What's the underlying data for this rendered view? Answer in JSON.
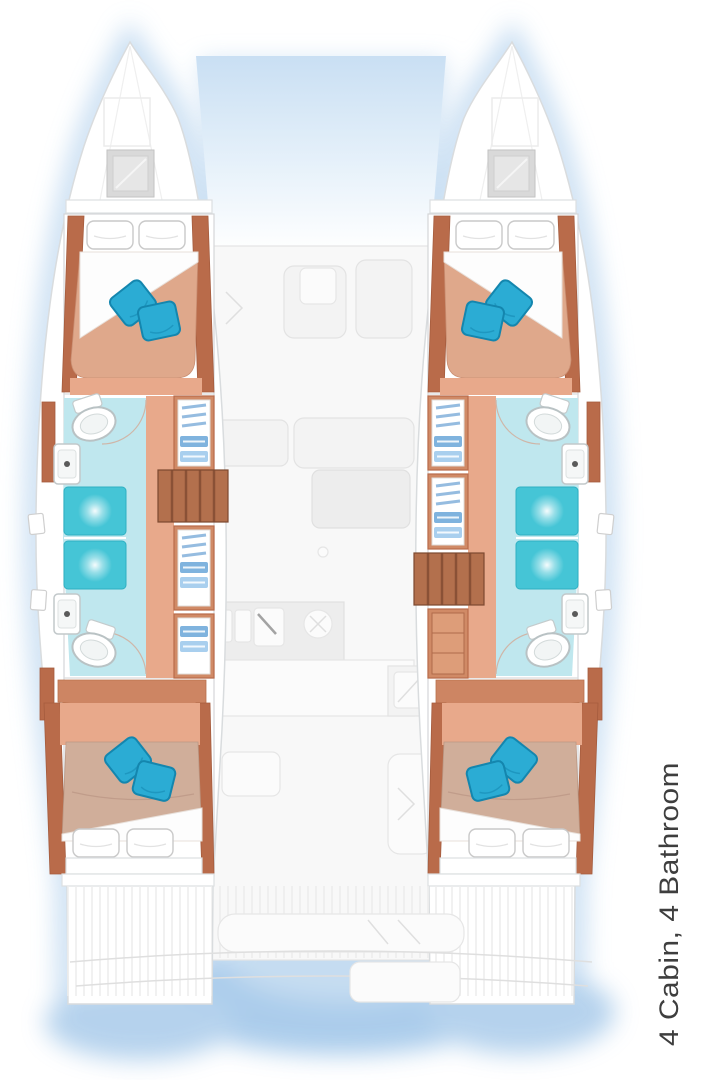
{
  "caption": {
    "text": "4 Cabin, 4 Bathroom"
  },
  "plan": {
    "type": "catamaran-floor-plan",
    "cabins": 4,
    "bathrooms": 4
  },
  "icons": [
    "double-bed-icon",
    "pillow-icon",
    "decor-pillow-icon",
    "toilet-icon",
    "shower-icon",
    "washbasin-icon",
    "wardrobe-icon",
    "stairs-icon",
    "deck-hatch-icon",
    "galley-sink-icon",
    "stove-icon",
    "cockpit-bench-icon"
  ],
  "colors": {
    "outline": "#d9dcde",
    "glow": "#bed8f0",
    "water": "#9dc4e8",
    "sky": "#c9dff3",
    "wood": "#b96b4a",
    "woodLight": "#d08a66",
    "woodMid": "#cd8563",
    "floor": "#e8a98b",
    "bedFwd": "#dfa88b",
    "bedAft": "#d0ae9a",
    "pillow": "#2bacd4",
    "pillowDark": "#1486ae",
    "bath": "#bfe7ee",
    "shower": "#45c5d6",
    "showerEdge": "#2fb0c2",
    "clothes": "#7fb3de",
    "clothesLight": "#a9cfee",
    "stairs": "#b3704d",
    "stairsLine": "#8a5136",
    "text": "#3e3e3e"
  }
}
